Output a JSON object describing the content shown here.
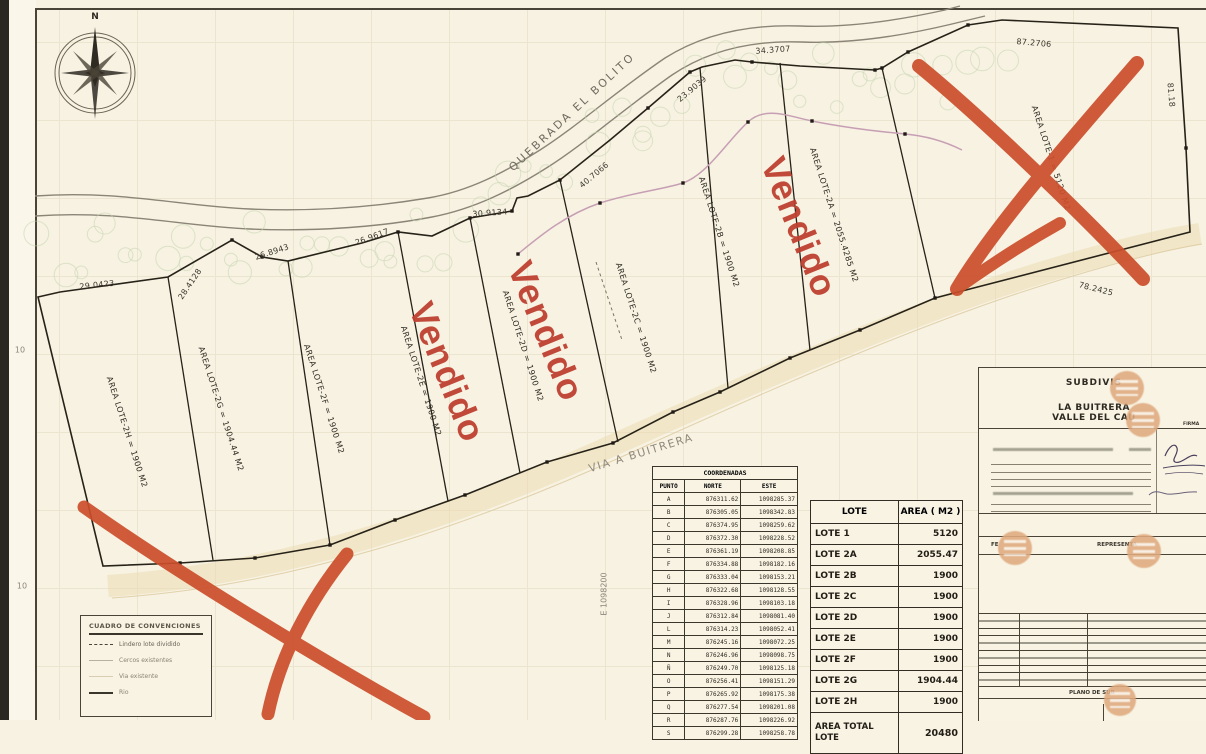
{
  "map": {
    "compass_label": "N",
    "creek_label": "QUEBRADA EL BOLITO",
    "road_label": "VIA A BUITRERA",
    "grid_east_label": "E 1098200",
    "edge_labels": [
      "10",
      "10"
    ],
    "sold_stamp": "Vendido",
    "sold_color": "#bf4030",
    "cross_color": "#cb4e2b",
    "lot_labels": [
      {
        "text": "AREA LOTE-2H = 1900 M2"
      },
      {
        "text": "AREA LOTE-2G = 1904.44 M2"
      },
      {
        "text": "AREA LOTE-2F = 1900 M2"
      },
      {
        "text": "AREA LOTE-2E = 1900 M2"
      },
      {
        "text": "AREA LOTE-2D = 1900 M2"
      },
      {
        "text": "AREA LOTE-2C = 1900 M2"
      },
      {
        "text": "AREA LOTE-2B = 1900 M2"
      },
      {
        "text": "AREA LOTE-2A = 2055.4285 M2"
      },
      {
        "text": "AREA LOTE-1 = 5120 M2"
      }
    ],
    "dimensions": [
      "29.0423",
      "28.4128",
      "26.8943",
      "26.9617",
      "30.9134",
      "40.7066",
      "23.9039",
      "34.3707",
      "87.2706",
      "78.2425",
      "81.18"
    ]
  },
  "coordinates_table": {
    "title": "COORDENADAS",
    "columns": [
      "PUNTO",
      "NORTE",
      "ESTE"
    ],
    "rows": [
      [
        "A",
        "876311.62",
        "1098285.37"
      ],
      [
        "B",
        "876305.05",
        "1098342.83"
      ],
      [
        "C",
        "876374.95",
        "1098259.62"
      ],
      [
        "D",
        "876372.30",
        "1098228.52"
      ],
      [
        "E",
        "876361.19",
        "1098208.85"
      ],
      [
        "F",
        "876334.88",
        "1098182.16"
      ],
      [
        "G",
        "876333.04",
        "1098153.21"
      ],
      [
        "H",
        "876322.68",
        "1098128.55"
      ],
      [
        "I",
        "876328.96",
        "1098103.18"
      ],
      [
        "J",
        "876312.84",
        "1098081.40"
      ],
      [
        "L",
        "876314.23",
        "1098052.41"
      ],
      [
        "M",
        "876245.16",
        "1098072.25"
      ],
      [
        "N",
        "876246.96",
        "1098098.75"
      ],
      [
        "Ñ",
        "876249.70",
        "1098125.18"
      ],
      [
        "O",
        "876256.41",
        "1098151.29"
      ],
      [
        "P",
        "876265.92",
        "1098175.38"
      ],
      [
        "Q",
        "876277.54",
        "1098201.08"
      ],
      [
        "R",
        "876287.76",
        "1098226.92"
      ],
      [
        "S",
        "876299.28",
        "1098258.78"
      ]
    ]
  },
  "lot_table": {
    "columns": [
      "LOTE",
      "AREA ( M2 )"
    ],
    "rows": [
      [
        "LOTE 1",
        "5120"
      ],
      [
        "LOTE 2A",
        "2055.47"
      ],
      [
        "LOTE 2B",
        "1900"
      ],
      [
        "LOTE 2C",
        "1900"
      ],
      [
        "LOTE 2D",
        "1900"
      ],
      [
        "LOTE 2E",
        "1900"
      ],
      [
        "LOTE 2F",
        "1900"
      ],
      [
        "LOTE 2G",
        "1904.44"
      ],
      [
        "LOTE 2H",
        "1900"
      ]
    ],
    "total_label": "AREA TOTAL LOTE",
    "total_value": "20480"
  },
  "legend": {
    "title": "CUADRO DE CONVENCIONES",
    "items": [
      {
        "label": "Lindero lote dividido"
      },
      {
        "label": "Cercos existentes"
      },
      {
        "label": "Via existente"
      },
      {
        "label": "Rio"
      }
    ]
  },
  "title_block": {
    "line1": "SUBDIVIS",
    "line2": "LA BUITRERA",
    "line3": "VALLE DEL CAU",
    "firma_label": "FIRMA",
    "fecha_label": "FE",
    "representante_label": "REPRESENTA",
    "plano_label": "PLANO DE SUB"
  }
}
